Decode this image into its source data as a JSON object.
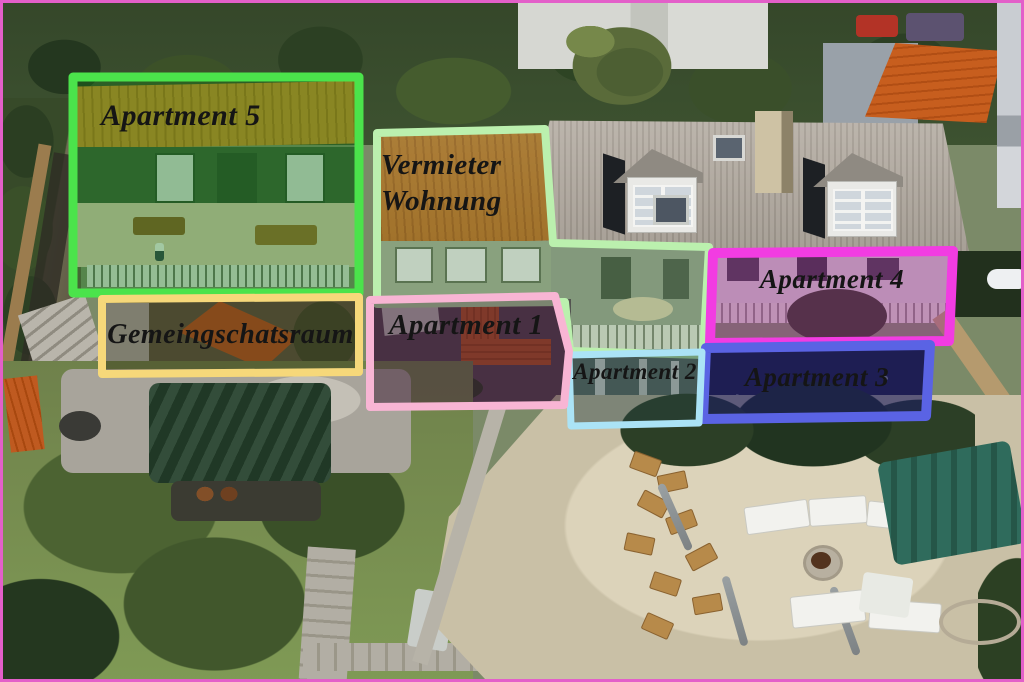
{
  "image": {
    "description": "Annotated aerial photo of a guesthouse property with labeled apartment areas",
    "frame_color": "#e35fc9"
  },
  "regions": [
    {
      "label": "Apartment 5",
      "border_color": "#4be34b",
      "fill_tint": "rgba(20,125,25,0.36)"
    },
    {
      "label": "Vermieter Wohnung",
      "border_color": "#bbf0ae",
      "fill_tint": "rgba(90,135,80,0.28)"
    },
    {
      "label": "Gemeingschatsraum",
      "border_color": "#f6d87a",
      "fill_tint": "rgba(55,52,25,0.42)"
    },
    {
      "label": "Apartment 1",
      "border_color": "#f8b5d4",
      "fill_tint": "rgba(65,35,55,0.52)"
    },
    {
      "label": "Apartment 2",
      "border_color": "#abe3f6",
      "fill_tint": "rgba(35,62,62,0.45)"
    },
    {
      "label": "Apartment 3",
      "border_color": "#5a63e4",
      "fill_tint": "rgba(28,28,95,0.62)"
    },
    {
      "label": "Apartment 4",
      "border_color": "#f23ce2",
      "fill_tint": "rgba(150,45,140,0.42)"
    }
  ]
}
